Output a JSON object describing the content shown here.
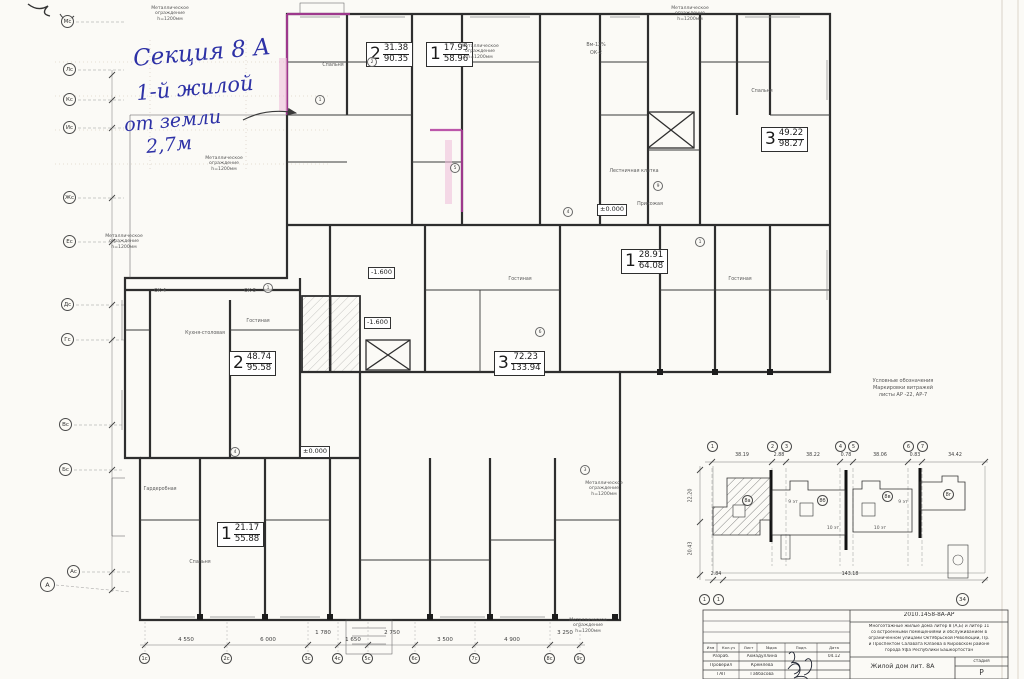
{
  "colors": {
    "paper": "#fbfaf6",
    "ink": "#2e2e2e",
    "highlight": "#b0399c",
    "handwriting": "#2d31a6"
  },
  "annotation": {
    "line1": "Секция 8 А",
    "line2": "1-й жилой",
    "line3": "от земли",
    "line4": "2,7м"
  },
  "fence_note": {
    "l1": "Металлическое",
    "l2": "ограждение",
    "l3": "h=1200мм"
  },
  "apartments": [
    {
      "rooms": "2",
      "living": "31.38",
      "total": "90.35"
    },
    {
      "rooms": "1",
      "living": "17.95",
      "total": "58.96"
    },
    {
      "rooms": "3",
      "living": "49.22",
      "total": "98.27"
    },
    {
      "rooms": "1",
      "living": "28.91",
      "total": "64.08"
    },
    {
      "rooms": "2",
      "living": "48.74",
      "total": "95.58"
    },
    {
      "rooms": "3",
      "living": "72.23",
      "total": "133.94"
    },
    {
      "rooms": "1",
      "living": "21.17",
      "total": "55.88"
    }
  ],
  "levels": [
    "±0.000",
    "±0.000",
    "-1.600",
    "-1.600"
  ],
  "rooms": [
    "Кухня-столовая",
    "Гостиная",
    "Гостиная",
    "Гостиная",
    "Прихожая",
    "Лестничная клетка",
    "Гардеробная",
    "Спальня",
    "Спальня",
    "Спальня"
  ],
  "marks": [
    "Вм-12%",
    "ОК-2",
    "ОК-4",
    "ОК-5"
  ],
  "plan_circles": [
    "1",
    "1",
    "2",
    "5",
    "4",
    "9",
    "1",
    "6",
    "4",
    "3"
  ],
  "grid_left": [
    "Мс",
    "Лс",
    "Кс",
    "Ис",
    "Жс",
    "Ес",
    "Дс",
    "Гс",
    "Вс",
    "Бс",
    "Ас",
    "А"
  ],
  "grid_bottom": [
    "1с",
    "2с",
    "3с",
    "4с",
    "5с",
    "6с",
    "7с",
    "8с",
    "9с"
  ],
  "dims_bottom": [
    "4 550",
    "6 000",
    "1 780",
    "1 650",
    "2 750",
    "3 500",
    "4 900",
    "3 250"
  ],
  "keyplan": {
    "axes_top": [
      "1",
      "2",
      "3",
      "4",
      "5",
      "6",
      "7"
    ],
    "axes_bottom": [
      "1",
      "1",
      "34"
    ],
    "dims_top": [
      "38.19",
      "2.88",
      "38.22",
      "0.78",
      "38.06",
      "0.83",
      "34.42"
    ],
    "dims_left": [
      "22.20",
      "20.43"
    ],
    "dim_bottom": "143.18",
    "dim_bottom_left": "2.84",
    "buildings": [
      {
        "tag": "8а",
        "floors": "9 эт"
      },
      {
        "tag": "8б",
        "floors": "10 эт"
      },
      {
        "tag": "8в",
        "floors": "10 эт"
      },
      {
        "tag": "8г",
        "floors": "9 эт"
      }
    ],
    "legend": {
      "l1": "Условные обозначения",
      "l2": "Маркировки витражей",
      "l3": "листы АР -22, АР-7"
    }
  },
  "titleblock": {
    "doc": "2010.1458-8А-АР",
    "desc1": "Многоэтажные жилые дома литер 8 (А,Б) и литер 11",
    "desc2": "со встроенными помещениями и обслуживанием в",
    "desc3": "ограниченном улицами Октябрьской Революции, Пр.",
    "desc4": "и Проспектом Салавата Юлаева в Кировском районе",
    "desc5": "города Уфа Республики Башкортостан",
    "subject": "Жилой дом лит. 8А",
    "stage_label": "стадия",
    "stage": "Р",
    "cols": [
      "Изм",
      "Кол.уч",
      "Лист",
      "№док",
      "Подп.",
      "Дата"
    ],
    "rows": [
      {
        "role": "Разраб.",
        "name": "Ахмадуллина",
        "date": "04.12"
      },
      {
        "role": "Проверил",
        "name": "Кремлева",
        "date": ""
      },
      {
        "role": "ГАП",
        "name": "Габбасова",
        "date": ""
      }
    ]
  }
}
